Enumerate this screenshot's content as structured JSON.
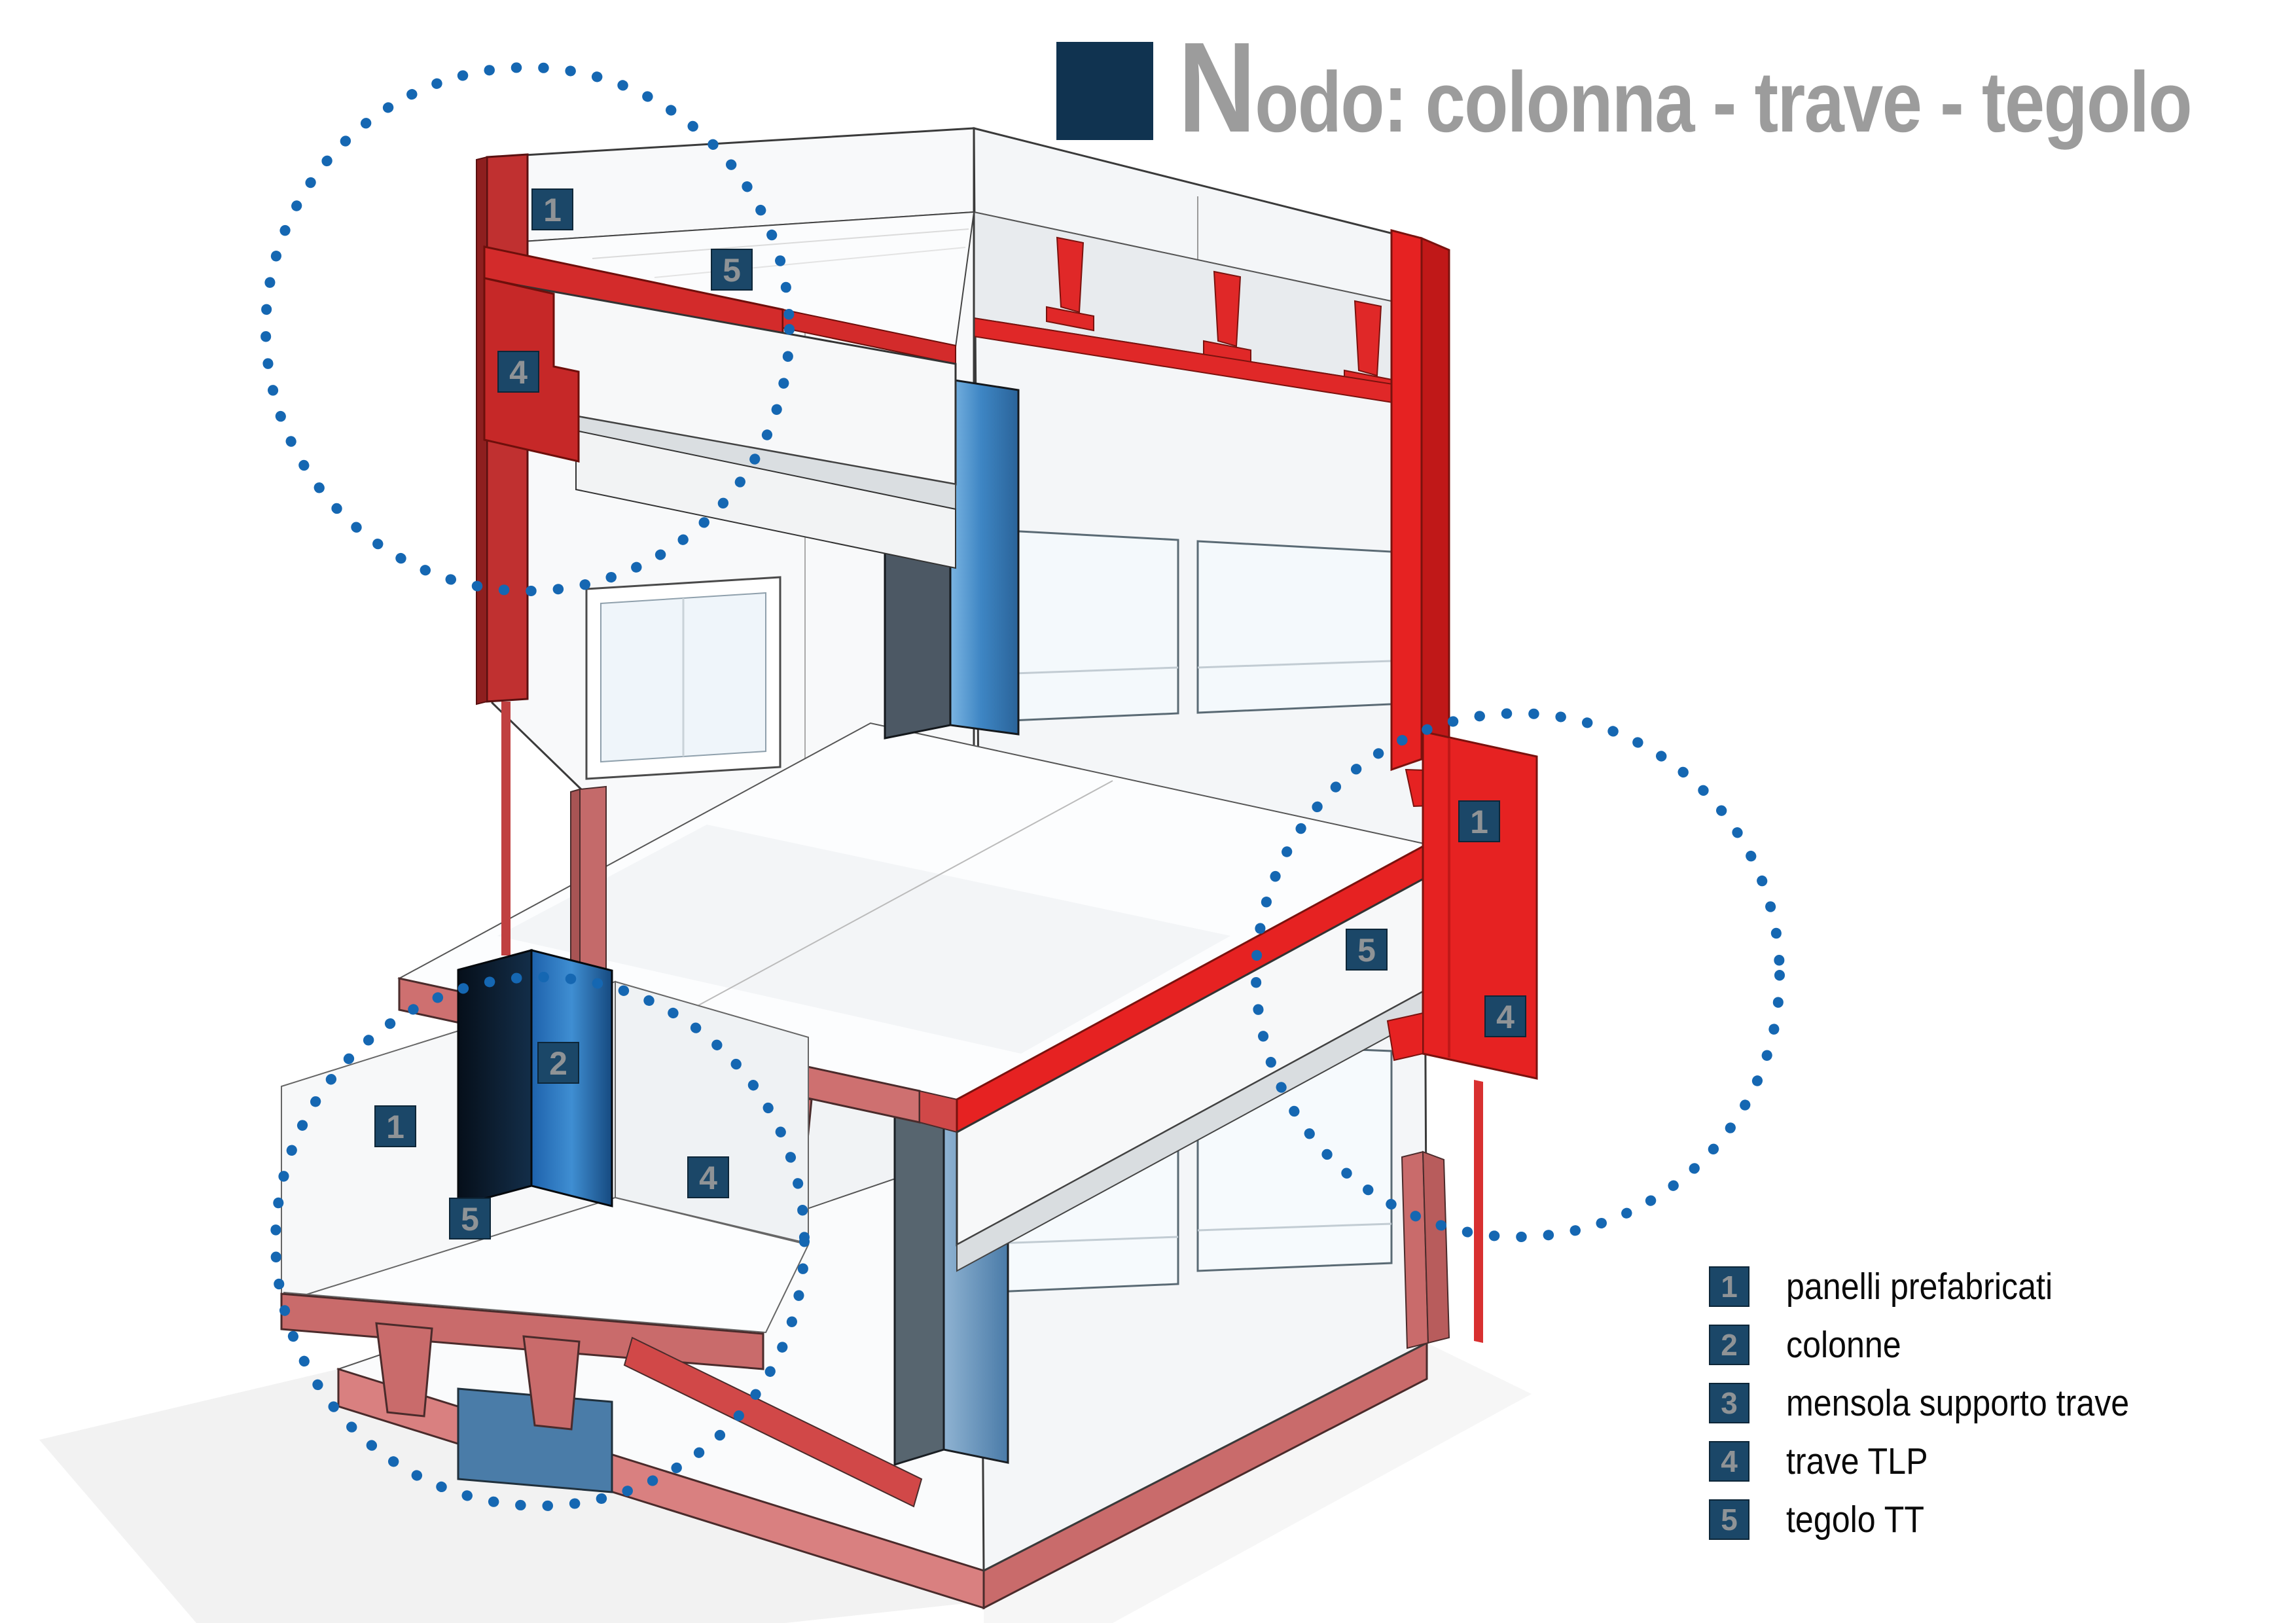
{
  "title": {
    "initial": "N",
    "rest": "odo: colonna - trave - tegolo",
    "square_color": "#103350",
    "text_color": "#9C9C9C"
  },
  "legend": {
    "items": [
      {
        "num": "1",
        "label": "panelli prefabricati"
      },
      {
        "num": "2",
        "label": "colonne"
      },
      {
        "num": "3",
        "label": "mensola supporto trave"
      },
      {
        "num": "4",
        "label": "trave TLP"
      },
      {
        "num": "5",
        "label": "tegolo TT"
      }
    ]
  },
  "callouts": {
    "top_left": {
      "badges": [
        {
          "n": "1"
        },
        {
          "n": "5"
        },
        {
          "n": "4"
        }
      ]
    },
    "right": {
      "badges": [
        {
          "n": "1"
        },
        {
          "n": "5"
        },
        {
          "n": "4"
        }
      ]
    },
    "bottom_left": {
      "badges": [
        {
          "n": "1"
        },
        {
          "n": "2"
        },
        {
          "n": "5"
        },
        {
          "n": "4"
        }
      ]
    }
  },
  "colors": {
    "badge_navy": "#1B4768",
    "badge_number_gray": "#8F9396",
    "dotted_circle_blue": "#1567B2",
    "highlight_red": "#E62222",
    "muted_red": "#C96B6B",
    "column_blue": "#3D85C8",
    "column_dark_navy": "#0A1C2E",
    "wall_white": "#F8F9FA"
  }
}
